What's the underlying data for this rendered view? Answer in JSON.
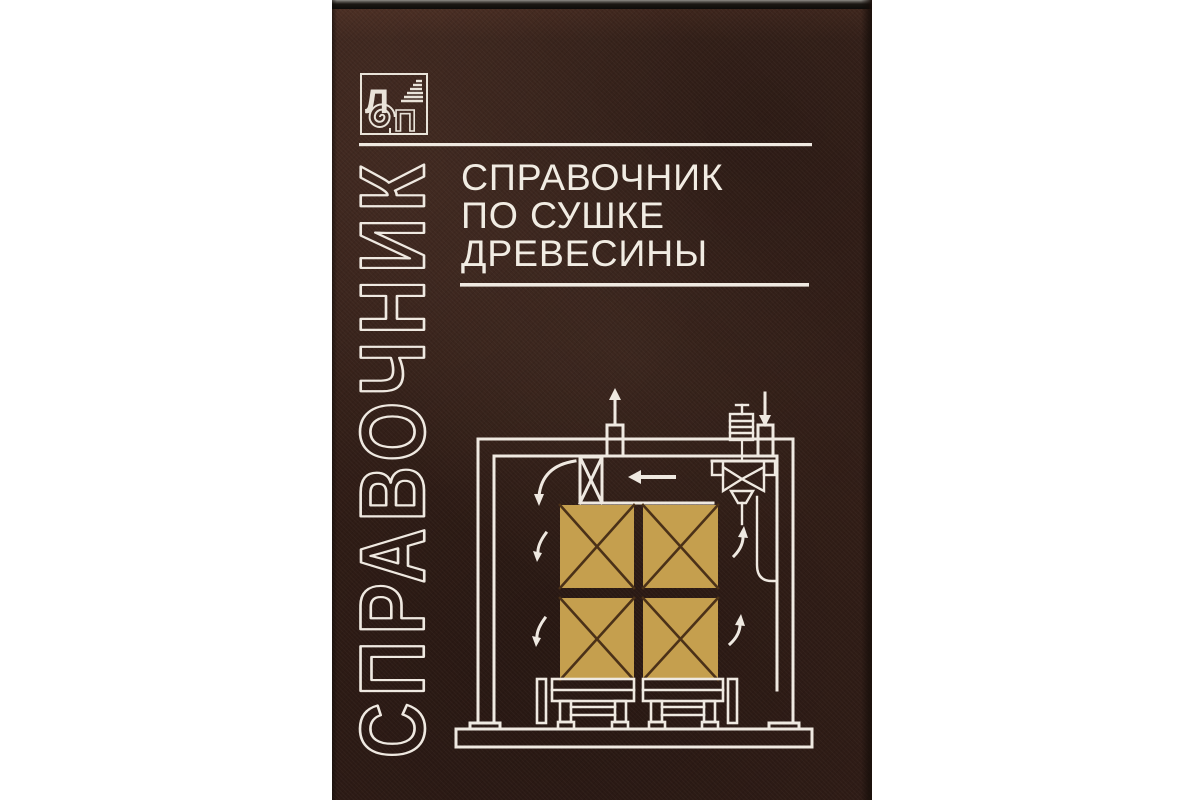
{
  "page": {
    "background_color": "#ffffff"
  },
  "book": {
    "cover_color": "#35201a",
    "line_color": "#efe9e1",
    "gold_color": "#c59f4e",
    "publisher_logo": {
      "letter_l": "Л",
      "letter_p": "П"
    },
    "spine_word": "СПРАВОЧНИК",
    "title": {
      "line1": "СПРАВОЧНИК",
      "line2": "ПО СУШКЕ",
      "line3": "ДРЕВЕСИНЫ"
    }
  }
}
